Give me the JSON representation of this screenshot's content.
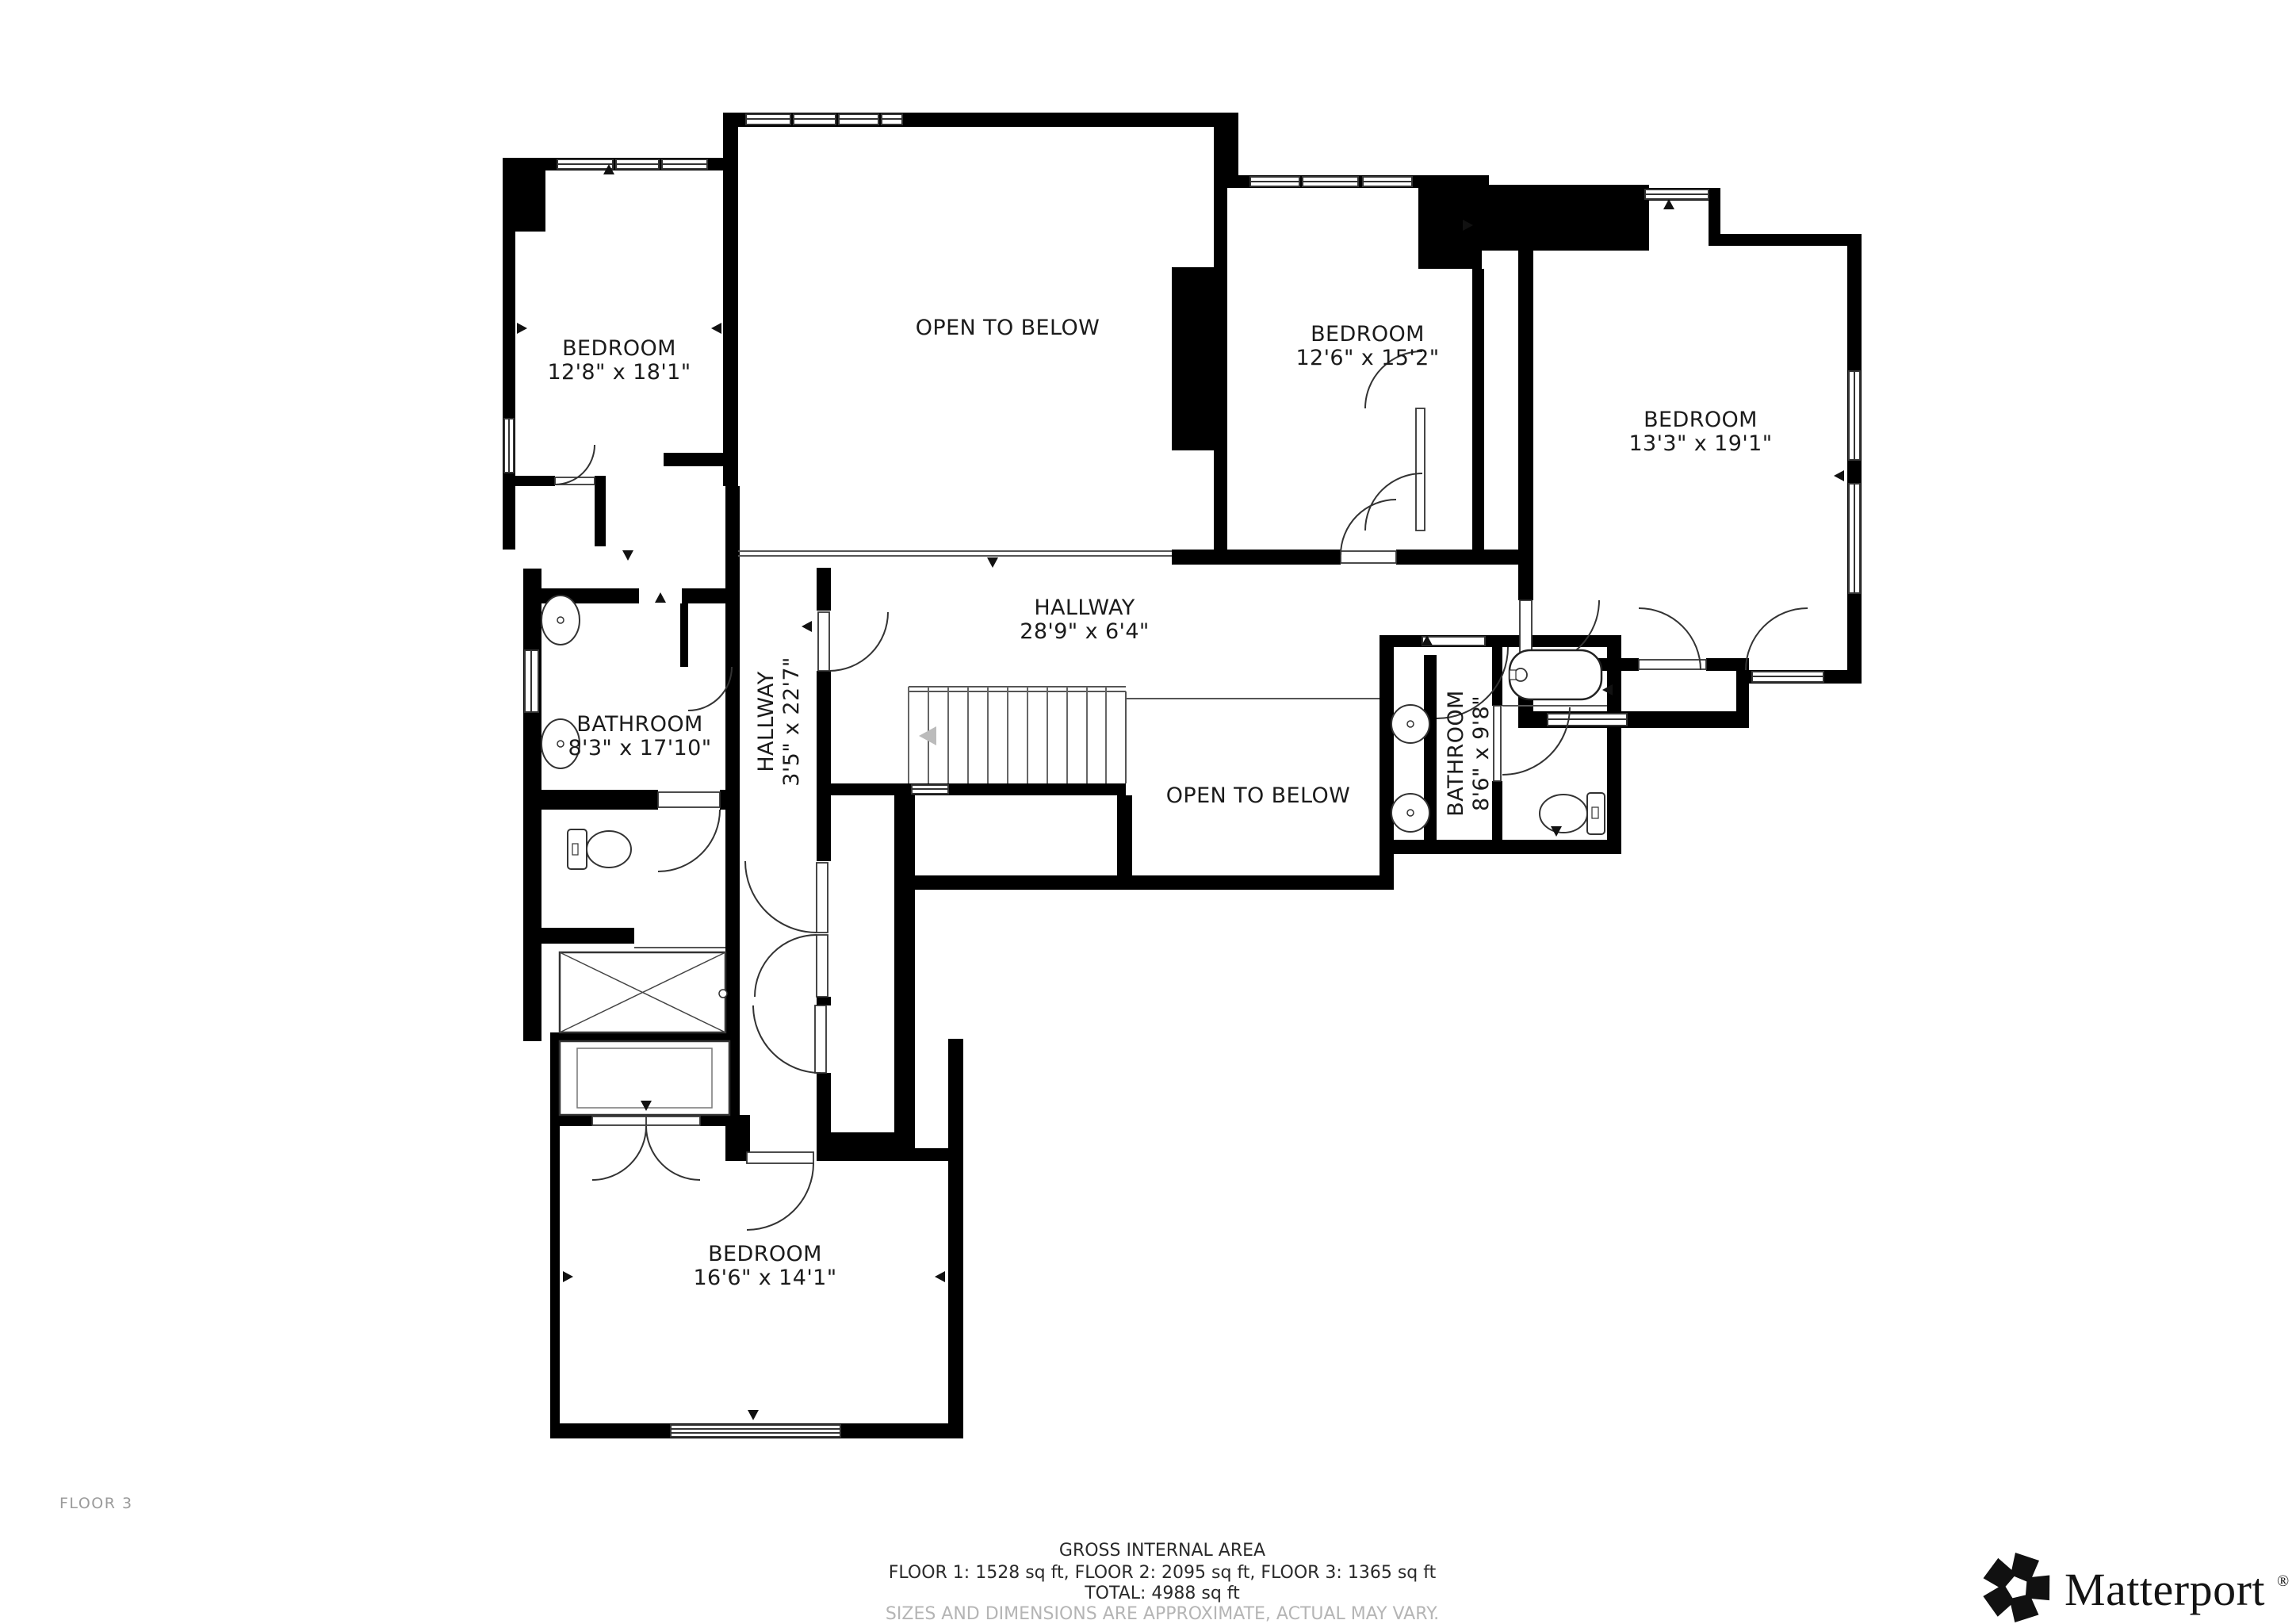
{
  "colors": {
    "wall": "#000000",
    "line": "#333333",
    "thin": "#555555",
    "muted_arrow": "#bbbbbb",
    "footer_muted": "#b5b5b5",
    "label_text": "#1b1b1b"
  },
  "floor_label": "FLOOR 3",
  "rooms": [
    {
      "id": "bedroom-1",
      "name": "BEDROOM",
      "dims": "12'8\" x 18'1\""
    },
    {
      "id": "open-to-below-upper",
      "name": "OPEN TO BELOW",
      "dims": ""
    },
    {
      "id": "bedroom-2",
      "name": "BEDROOM",
      "dims": "12'6\" x 15'2\""
    },
    {
      "id": "bedroom-3",
      "name": "BEDROOM",
      "dims": "13'3\" x 19'1\""
    },
    {
      "id": "hallway-main",
      "name": "HALLWAY",
      "dims": "28'9\" x 6'4\""
    },
    {
      "id": "bathroom-left",
      "name": "BATHROOM",
      "dims": "8'3\" x 17'10\""
    },
    {
      "id": "hallway-vertical",
      "name": "HALLWAY",
      "dims": "3'5\" x 22'7\""
    },
    {
      "id": "open-to-below-lower",
      "name": "OPEN TO BELOW",
      "dims": ""
    },
    {
      "id": "bathroom-right",
      "name": "BATHROOM",
      "dims": "8'6\" x 9'8\""
    },
    {
      "id": "bedroom-4",
      "name": "BEDROOM",
      "dims": "16'6\" x 14'1\""
    }
  ],
  "footer": {
    "line1": "GROSS INTERNAL AREA",
    "line2": "FLOOR 1: 1528 sq ft, FLOOR 2: 2095 sq ft, FLOOR 3: 1365 sq ft",
    "line3": "TOTAL: 4988 sq ft",
    "line4": "SIZES AND DIMENSIONS ARE APPROXIMATE, ACTUAL MAY VARY."
  },
  "brand": {
    "name": "Matterport",
    "registered": "®"
  }
}
